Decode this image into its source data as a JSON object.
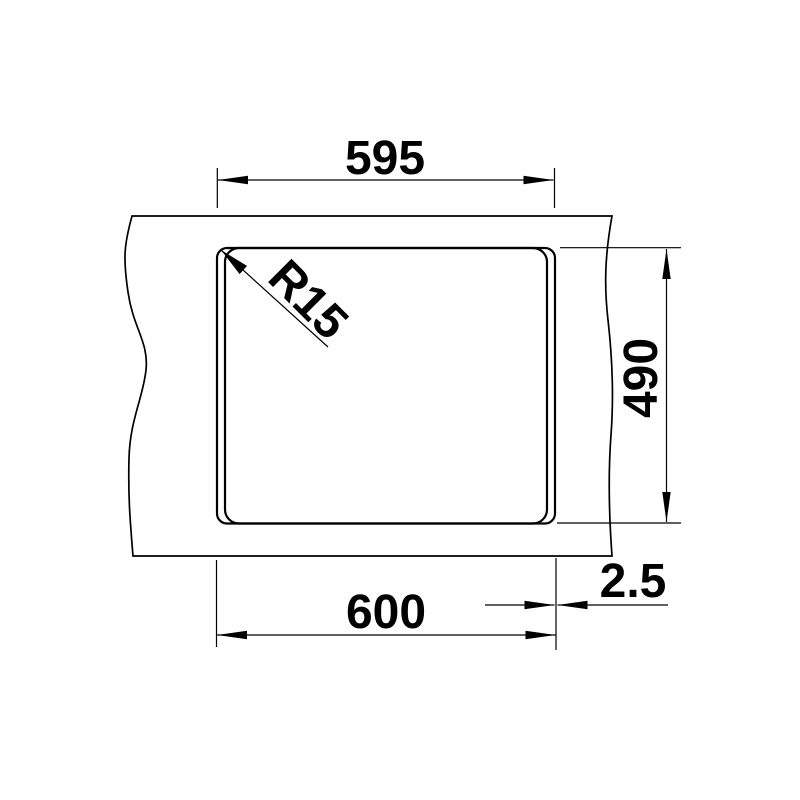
{
  "drawing": {
    "background_color": "#ffffff",
    "line_color": "#000000",
    "description": "technical-dimension-drawing-sink-cutout-top-view",
    "labels": {
      "top_width": "595",
      "bottom_width": "600",
      "right_height": "490",
      "edge_offset": "2.5",
      "corner_radius": "R15"
    }
  }
}
